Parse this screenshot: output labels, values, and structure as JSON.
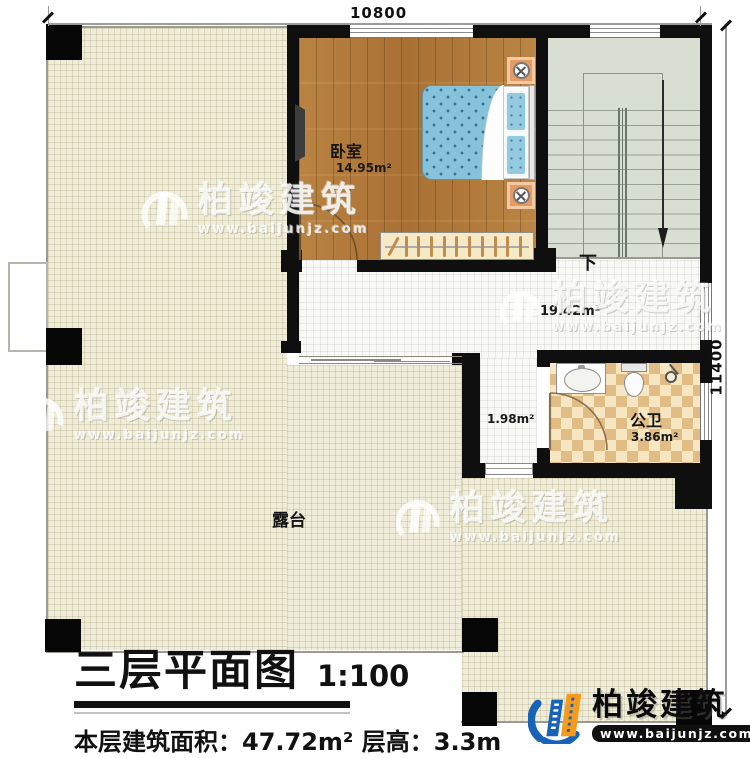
{
  "plan": {
    "dimensions": {
      "top": "10800",
      "right": "11400"
    },
    "rooms": {
      "bedroom": {
        "label": "卧室",
        "area": "14.95m²"
      },
      "stairs": {
        "down": "下"
      },
      "corridor": {
        "area": "19.42m²"
      },
      "vestibule": {
        "area": "1.98m²"
      },
      "bathroom": {
        "label": "公卫",
        "area": "3.86m²"
      },
      "terrace": {
        "label": "露台"
      }
    }
  },
  "title_block": {
    "title": "三层平面图",
    "scale": "1:100",
    "info": "本层建筑面积：47.72m²  层高：3.3m"
  },
  "watermark": {
    "name": "柏竣建筑",
    "url": "www.baijunjz.com"
  },
  "brand": {
    "name": "柏竣建筑",
    "url": "www.baijunjz.com"
  }
}
